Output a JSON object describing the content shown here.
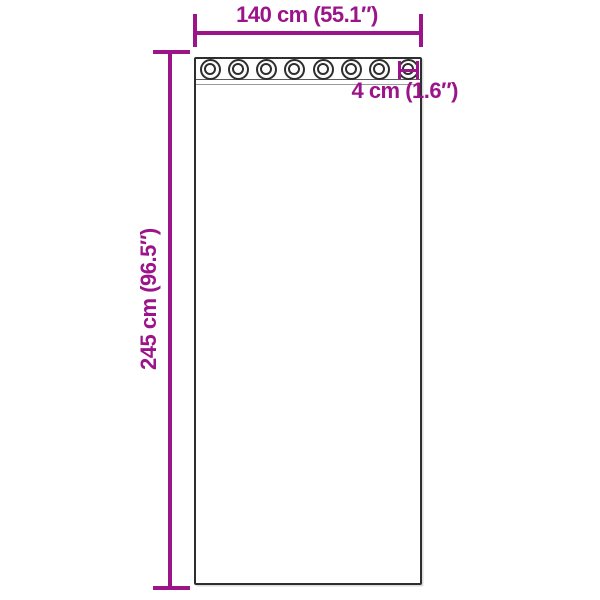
{
  "diagram": {
    "curtain": {
      "grommet_count": 8
    },
    "dimensions": {
      "width": {
        "label": "140 cm (55.1″)"
      },
      "height": {
        "label": "245 cm (96.5″)"
      },
      "grommet_diameter": {
        "label": "4 cm (1.6″)"
      }
    },
    "colors": {
      "dimension_accent": "#9b1489",
      "panel_outline": "#2e2e2e",
      "seam": "#5a5a5a",
      "background": "#ffffff"
    }
  }
}
